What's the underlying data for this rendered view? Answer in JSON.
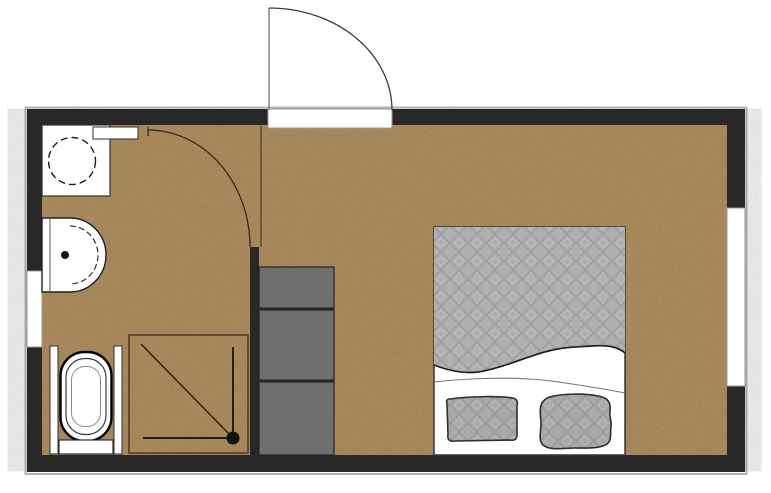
{
  "plan": {
    "kind": "architectural floor plan",
    "canvas": {
      "width": 771,
      "height": 493
    },
    "rooms": [
      "bathroom",
      "entry-hall",
      "bedroom"
    ],
    "elements": [
      "exterior-wall",
      "entrance-door",
      "bathroom-door",
      "partition-wall",
      "window-left",
      "window-right",
      "appliance-cabinet",
      "wall-shelf",
      "countertop-basin",
      "toilet",
      "shower",
      "shower-drain",
      "wardrobe",
      "double-bed",
      "duvet",
      "sheet",
      "pillow-left",
      "pillow-right"
    ],
    "wardrobe_sections": 3,
    "pillow_count": 2
  },
  "colors": {
    "background": "#ffffff",
    "floor": "#b28c57",
    "wall": "#282828",
    "wall_outline": "#b3b3b3",
    "window": "#ffffff",
    "window_frame": "#999999",
    "door_leaf": "#8a8a8a",
    "door_arc": "#3c3c3c",
    "bath_door_arc": "#302b20",
    "room_divider_line": "#5d4a2c",
    "fixture": "#ffffff",
    "fixture_outline": "#2e2e2e",
    "wardrobe": "#6f6f6f",
    "wardrobe_divider": "#242424",
    "shower_frame": "#54432a",
    "shower_line": "#1e1e1e",
    "drain": "#111111",
    "bed_outline": "#333333",
    "sheet": "#ffffff",
    "bedding": "#afafaf",
    "bedding_line": "#9c9c9c",
    "bedding_highlight": "#bcbcbc",
    "pillow": "#a9a9a9",
    "pillow_outline": "#2e2e2e"
  }
}
